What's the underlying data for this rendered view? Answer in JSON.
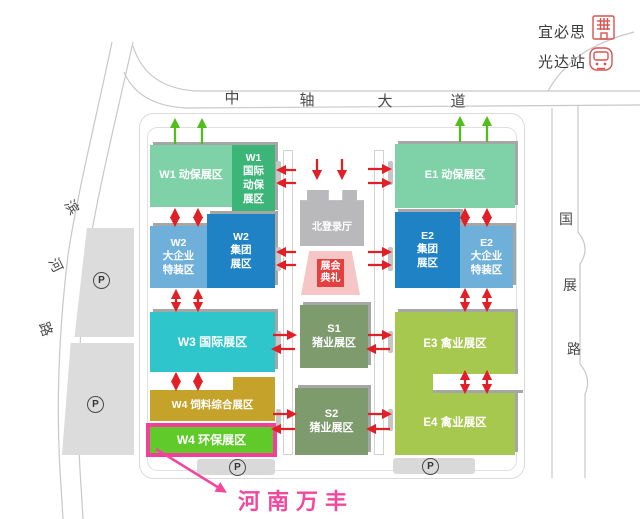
{
  "landmarks": {
    "hotel": {
      "label": "宜必思"
    },
    "station": {
      "label": "光达站"
    }
  },
  "roads": {
    "central_avenue": {
      "name": "中轴大道",
      "chars": [
        "中",
        "轴",
        "大",
        "道"
      ]
    },
    "binhe_road": {
      "name": "滨河路",
      "chars": [
        "滨",
        "河",
        "路"
      ]
    },
    "guozhan_road": {
      "name": "国展路",
      "chars": [
        "国",
        "展",
        "路"
      ]
    }
  },
  "halls": {
    "w1": {
      "label": "W1 动保展区"
    },
    "w1_intl": {
      "lines": [
        "W1",
        "国际",
        "动保",
        "展区"
      ]
    },
    "w2_special": {
      "lines": [
        "W2",
        "大企业",
        "特装区"
      ]
    },
    "w2_group": {
      "lines": [
        "W2",
        "集团",
        "展区"
      ]
    },
    "w3": {
      "label": "W3 国际展区"
    },
    "w4_feed": {
      "label": "W4 饲料综合展区"
    },
    "w4_env": {
      "label": "W4 环保展区"
    },
    "e1": {
      "label": "E1 动保展区"
    },
    "e2_group": {
      "lines": [
        "E2",
        "集团",
        "展区"
      ]
    },
    "e2_special": {
      "lines": [
        "E2",
        "大企业",
        "特装区"
      ]
    },
    "e3": {
      "label": "E3 禽业展区"
    },
    "e4": {
      "label": "E4 禽业展区"
    },
    "s1": {
      "lines": [
        "S1",
        "猪业展区"
      ]
    },
    "s2": {
      "lines": [
        "S2",
        "猪业展区"
      ]
    },
    "north_hall": {
      "label": "北登录厅"
    },
    "ceremony": {
      "lines": [
        "展会",
        "典礼"
      ]
    }
  },
  "parking": {
    "symbol": "P"
  },
  "callout": {
    "label": "河南万丰"
  },
  "colors": {
    "mint": "#7fd1a8",
    "green": "#3cb579",
    "light_blue": "#6fb0da",
    "blue": "#1f82c4",
    "cyan": "#2ec6cb",
    "gold": "#c5a32b",
    "bright_green": "#61ca2b",
    "highlight_pink": "#f2409a",
    "olive": "#7e9b6e",
    "yellow_green": "#a6c84e",
    "gray_building": "#b9b9bb",
    "ceremony_pink": "#f6c6c6",
    "ceremony_red": "#e54040",
    "arrow_red": "#e01f26",
    "arrow_green": "#53bd20",
    "road_line": "#c8c8c8"
  }
}
